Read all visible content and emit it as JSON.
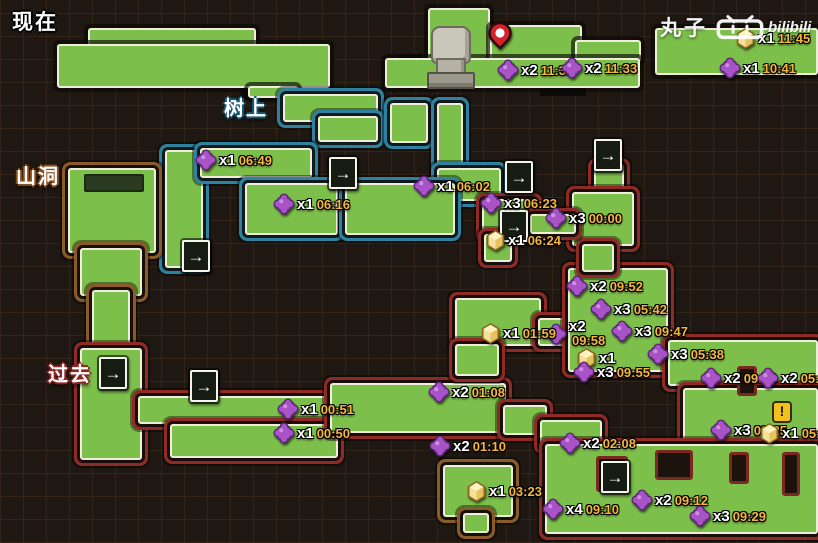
{
  "canvas": {
    "width": 818,
    "height": 543
  },
  "labels": {
    "now": "现在",
    "tree": "树上",
    "cave": "山洞",
    "past": "过去"
  },
  "watermark": {
    "name": "丸子",
    "brand": "bilibili"
  },
  "marker_types": {
    "puzzle": "puzzle-fragment-collectible",
    "honey": "honeycomb-collectible",
    "arrow": "level-transition-arrow",
    "pin": "current-location-pin",
    "alert": "exclamation-alert"
  },
  "colors": {
    "map_green": "#7dbf4b",
    "outline_cream": "#efeedb",
    "region_tree_blue": "#2e82a0",
    "region_cave_brown": "#8a5a28",
    "region_past_red": "#8e2b26",
    "count_text": "#ffffff",
    "time_text": "#f6b63c",
    "puzzle_purple": "#a854c7",
    "honey_yellow": "#f4e098",
    "pin_red": "#d6202a",
    "background": "#1f1812"
  },
  "markers": [
    {
      "type": "pin",
      "x": 500,
      "y": 52
    },
    {
      "type": "puzzle",
      "count": "x2",
      "time": "11:36",
      "x": 508,
      "y": 70
    },
    {
      "type": "puzzle",
      "count": "x2",
      "time": "11:33",
      "x": 572,
      "y": 68
    },
    {
      "type": "honey",
      "count": "x1",
      "time": "11:45",
      "x": 746,
      "y": 38
    },
    {
      "type": "puzzle",
      "count": "x1",
      "time": "10:41",
      "x": 730,
      "y": 68
    },
    {
      "type": "puzzle",
      "count": "x1",
      "time": "06:49",
      "x": 206,
      "y": 160
    },
    {
      "type": "puzzle",
      "count": "x1",
      "time": "06:16",
      "x": 284,
      "y": 204
    },
    {
      "type": "puzzle",
      "count": "x1",
      "time": "06:02",
      "x": 424,
      "y": 186
    },
    {
      "type": "arrow",
      "x": 340,
      "y": 168
    },
    {
      "type": "arrow",
      "x": 516,
      "y": 172
    },
    {
      "type": "arrow",
      "x": 605,
      "y": 150
    },
    {
      "type": "arrow",
      "x": 193,
      "y": 251
    },
    {
      "type": "arrow",
      "x": 110,
      "y": 368
    },
    {
      "type": "arrow",
      "x": 201,
      "y": 381
    },
    {
      "type": "arrow",
      "x": 511,
      "y": 221
    },
    {
      "type": "arrow",
      "x": 612,
      "y": 472
    },
    {
      "type": "puzzle",
      "count": "x3",
      "time": "06:23",
      "x": 491,
      "y": 203
    },
    {
      "type": "puzzle",
      "count": "x3",
      "time": "00:00",
      "x": 556,
      "y": 218
    },
    {
      "type": "honey",
      "count": "x1",
      "time": "06:24",
      "x": 496,
      "y": 240
    },
    {
      "type": "puzzle",
      "count": "x2",
      "time": "09:52",
      "x": 577,
      "y": 286
    },
    {
      "type": "puzzle",
      "count": "x3",
      "time": "05:42",
      "x": 601,
      "y": 309
    },
    {
      "type": "puzzle",
      "count": "x3",
      "time": "09:47",
      "x": 622,
      "y": 331
    },
    {
      "type": "puzzle",
      "count": "x2",
      "time": "09:58",
      "stacked": true,
      "x": 556,
      "y": 336
    },
    {
      "type": "honey",
      "count": "x1",
      "time": "01:59",
      "x": 491,
      "y": 333
    },
    {
      "type": "honey",
      "count": "x1",
      "time": "",
      "x": 587,
      "y": 358
    },
    {
      "type": "puzzle",
      "count": "x3",
      "time": "09:55",
      "x": 584,
      "y": 372
    },
    {
      "type": "puzzle",
      "count": "x3",
      "time": "05:38",
      "x": 658,
      "y": 354
    },
    {
      "type": "puzzle",
      "count": "x2",
      "time": "09:39",
      "x": 711,
      "y": 378
    },
    {
      "type": "puzzle",
      "count": "x2",
      "time": "05:33",
      "x": 768,
      "y": 378
    },
    {
      "type": "puzzle",
      "count": "x1",
      "time": "00:51",
      "x": 288,
      "y": 409
    },
    {
      "type": "puzzle",
      "count": "x1",
      "time": "00:50",
      "x": 284,
      "y": 433
    },
    {
      "type": "puzzle",
      "count": "x2",
      "time": "01:08",
      "x": 439,
      "y": 392
    },
    {
      "type": "puzzle",
      "count": "x2",
      "time": "01:10",
      "x": 440,
      "y": 446
    },
    {
      "type": "puzzle",
      "count": "x2",
      "time": "02:08",
      "x": 570,
      "y": 443
    },
    {
      "type": "honey",
      "count": "x1",
      "time": "03:23",
      "x": 477,
      "y": 491
    },
    {
      "type": "puzzle",
      "count": "x4",
      "time": "09:10",
      "x": 553,
      "y": 509
    },
    {
      "type": "puzzle",
      "count": "x2",
      "time": "09:12",
      "x": 642,
      "y": 500
    },
    {
      "type": "puzzle",
      "count": "x3",
      "time": "09:29",
      "x": 700,
      "y": 516
    },
    {
      "type": "puzzle",
      "count": "x3",
      "time": "09:25",
      "x": 721,
      "y": 430
    },
    {
      "type": "honey",
      "count": "x1",
      "time": "05:31",
      "alert": true,
      "x": 770,
      "y": 433
    }
  ]
}
